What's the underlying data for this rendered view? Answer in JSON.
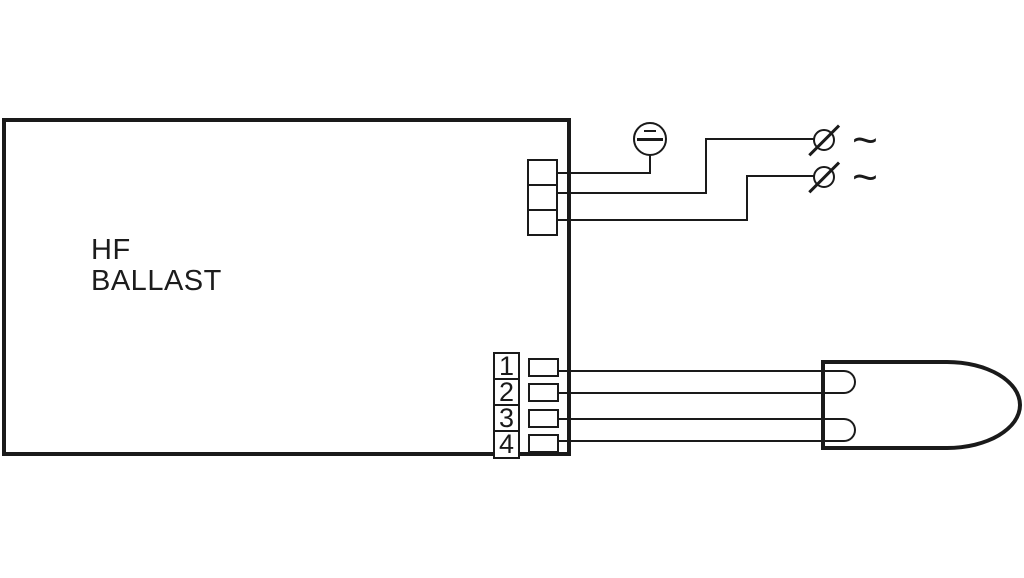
{
  "diagram": {
    "title": "HF ballast wiring diagram",
    "ballast": {
      "label_line1": "HF",
      "label_line2": "BALLAST"
    },
    "mains_terminal_block": {
      "terminal_count": 3
    },
    "earth": {
      "symbol_name": "protective-earth-symbol"
    },
    "ac_labels": [
      "~",
      "~"
    ],
    "lamp_terminal_block": {
      "numbers": [
        "1",
        "2",
        "3",
        "4"
      ]
    },
    "lamp": {
      "symbol_name": "fluorescent-lamp",
      "filament_count": 2
    },
    "colors": {
      "stroke": "#1a1a1a",
      "background": "#ffffff"
    }
  }
}
